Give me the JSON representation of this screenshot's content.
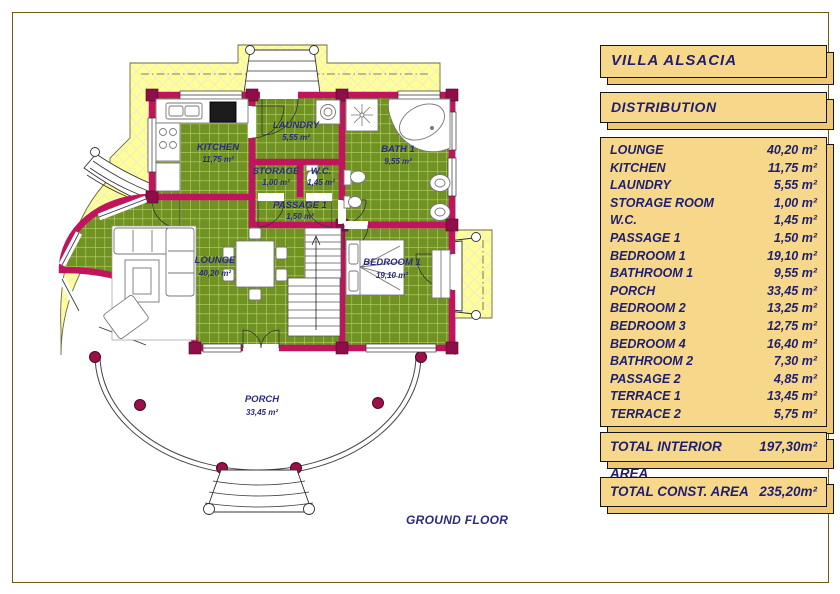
{
  "header": {
    "title": "VILLA  ALSACIA",
    "section": "DISTRIBUTION"
  },
  "distribution": {
    "rows": [
      {
        "name": "LOUNGE",
        "area": "40,20 m²"
      },
      {
        "name": "KITCHEN",
        "area": "11,75 m²"
      },
      {
        "name": "LAUNDRY",
        "area": "5,55 m²"
      },
      {
        "name": "STORAGE ROOM",
        "area": "1,00 m²"
      },
      {
        "name": "W.C.",
        "area": "1,45 m²"
      },
      {
        "name": "PASSAGE 1",
        "area": "1,50 m²"
      },
      {
        "name": "BEDROOM 1",
        "area": "19,10 m²"
      },
      {
        "name": "BATHROOM 1",
        "area": "9,55 m²"
      },
      {
        "name": "PORCH",
        "area": "33,45 m²"
      },
      {
        "name": "BEDROOM 2",
        "area": "13,25 m²"
      },
      {
        "name": "BEDROOM 3",
        "area": "12,75 m²"
      },
      {
        "name": "BEDROOM 4",
        "area": "16,40 m²"
      },
      {
        "name": "BATHROOM 2",
        "area": "7,30 m²"
      },
      {
        "name": "PASSAGE 2",
        "area": "4,85 m²"
      },
      {
        "name": "TERRACE 1",
        "area": "13,45 m²"
      },
      {
        "name": "TERRACE 2",
        "area": "5,75 m²"
      }
    ]
  },
  "totals": {
    "interior": {
      "label": "TOTAL INTERIOR AREA",
      "value": "197,30m²"
    },
    "construction": {
      "label": "TOTAL CONST. AREA",
      "value": "235,20m²"
    }
  },
  "plan": {
    "floor_label": "GROUND FLOOR",
    "rooms": [
      {
        "name": "KITCHEN",
        "area": "11,75 m²"
      },
      {
        "name": "LAUNDRY",
        "area": "5,55 m²"
      },
      {
        "name": "STORAGE",
        "area": "1,00 m²"
      },
      {
        "name": "W.C.",
        "area": "1,45 m²"
      },
      {
        "name": "BATH 1",
        "area": "9,55 m²"
      },
      {
        "name": "PASSAGE 1",
        "area": "1,50 m²"
      },
      {
        "name": "LOUNGE",
        "area": "40,20 m²"
      },
      {
        "name": "BEDROOM 1",
        "area": "19,10 m²"
      },
      {
        "name": "PORCH",
        "area": "33,45 m²"
      }
    ]
  },
  "colors": {
    "wall_magenta": "#c0145f",
    "tile_green": "#6f9222",
    "plot_yellow": "#ffff96",
    "panel_tan": "#f7d88b",
    "label_navy": "#2b2b80"
  }
}
